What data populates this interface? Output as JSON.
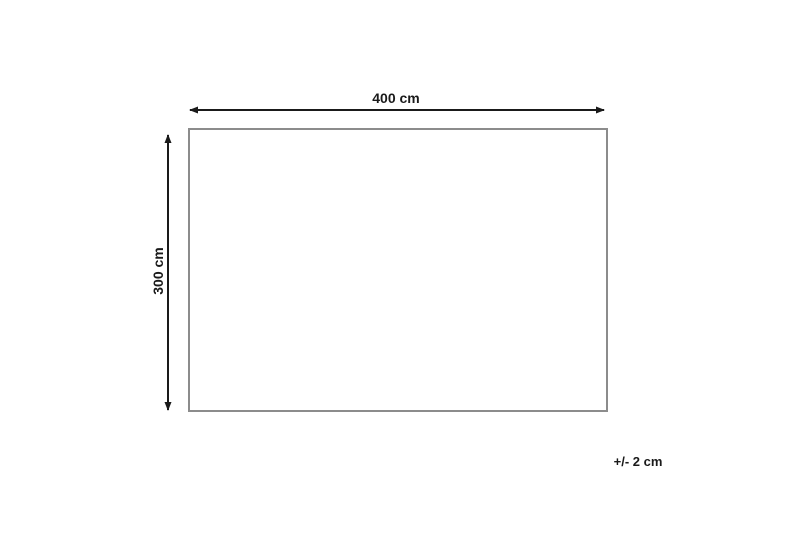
{
  "diagram": {
    "width_label": "400 cm",
    "height_label": "300 cm",
    "tolerance_label": "+/- 2 cm",
    "dimensions": {
      "width_cm": 400,
      "height_cm": 300,
      "tolerance_cm": 2
    },
    "colors": {
      "background": "#ffffff",
      "arrow": "#1a1a1a",
      "text": "#1a1a1a",
      "rectangle_border": "#8c8c8c"
    }
  }
}
